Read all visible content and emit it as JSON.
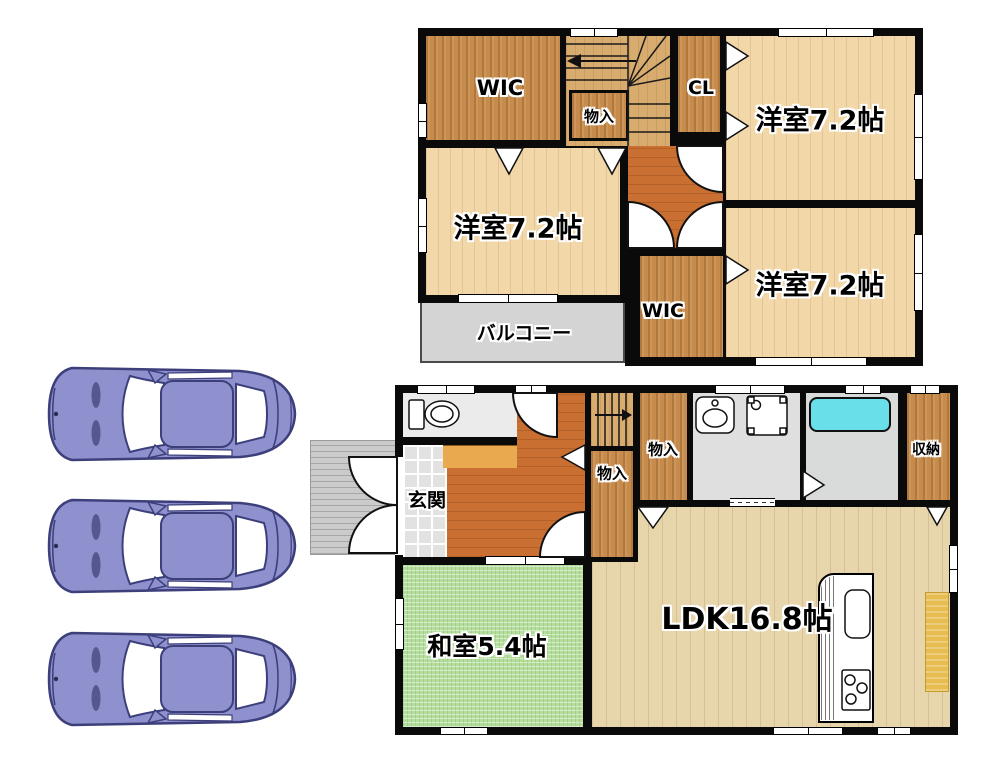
{
  "floor2": {
    "wic_top": "WIC",
    "closet": "物入",
    "cl": "CL",
    "room_top_right": "洋室7.2帖",
    "room_left": "洋室7.2帖",
    "room_bottom_right": "洋室7.2帖",
    "wic_bottom": "WIC",
    "balcony": "バルコニー"
  },
  "floor1": {
    "entrance": "玄関",
    "closet_upper": "物入",
    "closet_lower": "物入",
    "storage": "収納",
    "tatami_room": "和室5.4帖",
    "ldk": "LDK16.8帖"
  },
  "parking": {
    "car_count": 3
  },
  "colors": {
    "wall": "#0a0a0a",
    "hall_wood": "#c96f31",
    "light_wood": "#f2d7a9",
    "dark_wood": "#c78c4c",
    "ldk_wood": "#e7d5ac",
    "tatami_green": "#b5dd9e",
    "bathtub_cyan": "#68dfe9",
    "balcony_gray": "#d4d4d4",
    "car_purple": "#8f91cf",
    "kitchen_mat_yellow": "#e7bc50"
  }
}
